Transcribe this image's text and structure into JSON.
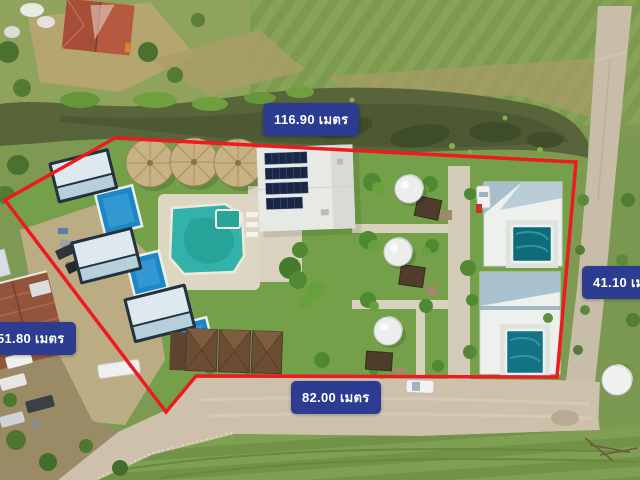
{
  "scene": {
    "type": "aerial-drone-photo",
    "features": [
      "canal",
      "red-property-boundary",
      "pool-villas",
      "solar-panel-roof",
      "lagoon-pool",
      "thatched-umbrellas",
      "dome-tents",
      "access-road",
      "parked-cars",
      "lawns",
      "neighbor-house",
      "dirt-road"
    ]
  },
  "measurements": {
    "top": {
      "text": "116.90 เมตร",
      "value": "116.90",
      "unit": "เมตร"
    },
    "right": {
      "text": "41.10 เมตร",
      "value": "41.10",
      "unit": "เมตร"
    },
    "left": {
      "text": "51.80 เมตร",
      "value": "51.80",
      "unit": "เมตร"
    },
    "bottom": {
      "text": "82.00 เมตร",
      "value": "82.00",
      "unit": "เมตร"
    }
  },
  "colors": {
    "boundary_line": "#ed1b1f",
    "label_background": "#2c3c90",
    "label_text": "#ffffff"
  }
}
